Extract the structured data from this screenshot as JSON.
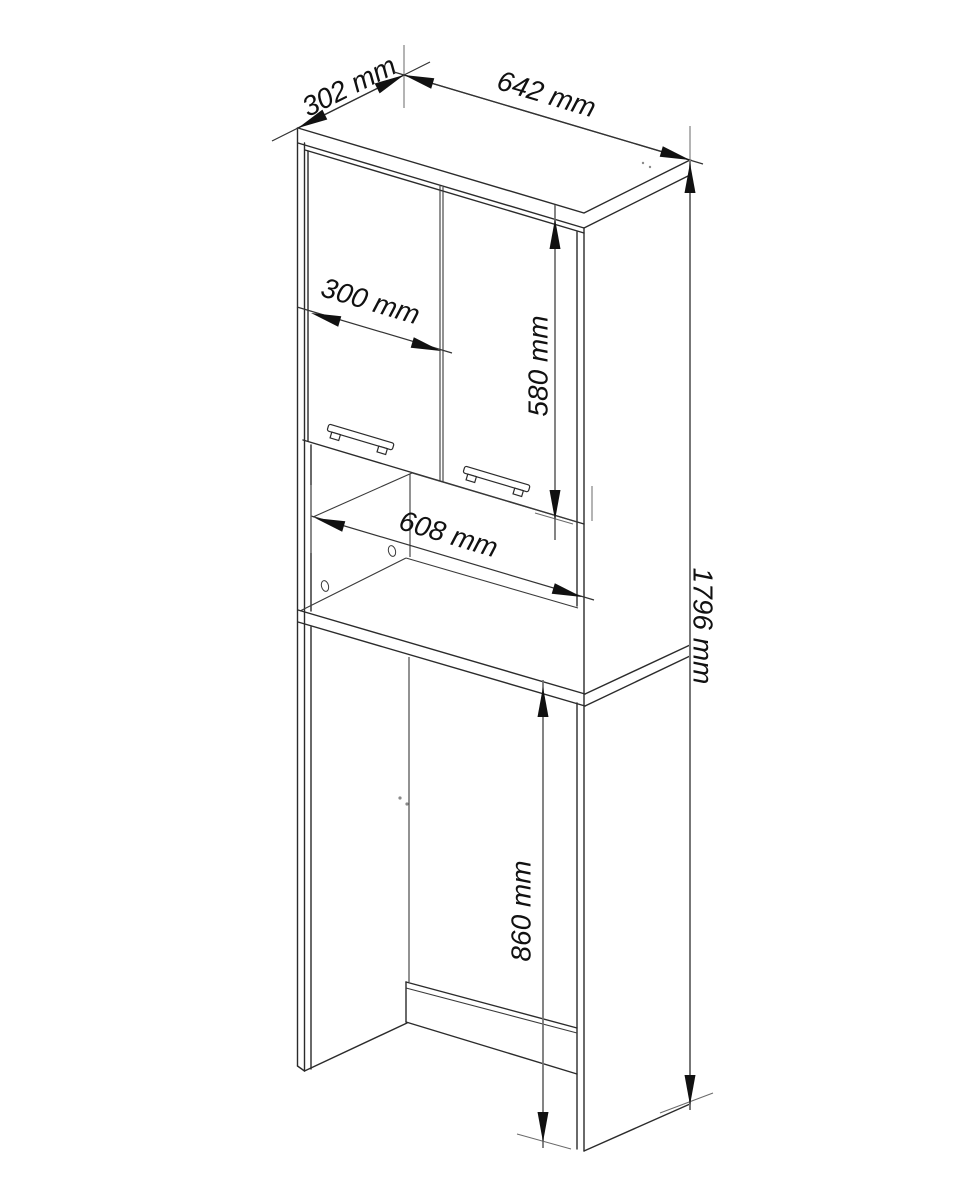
{
  "diagram": {
    "unit": "mm",
    "colors": {
      "background": "#ffffff",
      "line": "#2b2b2b",
      "dimension_line": "#777777",
      "text": "#111111"
    },
    "dimensions": {
      "top_depth": {
        "label": "302 mm",
        "value": 302,
        "unit": "mm"
      },
      "top_width": {
        "label": "642 mm",
        "value": 642,
        "unit": "mm"
      },
      "door_width": {
        "label": "300 mm",
        "value": 300,
        "unit": "mm"
      },
      "door_height": {
        "label": "580 mm",
        "value": 580,
        "unit": "mm"
      },
      "niche_width": {
        "label": "608 mm",
        "value": 608,
        "unit": "mm"
      },
      "total_height": {
        "label": "1796 mm",
        "value": 1796,
        "unit": "mm"
      },
      "machine_niche_height": {
        "label": "860 mm",
        "value": 860,
        "unit": "mm"
      }
    }
  }
}
